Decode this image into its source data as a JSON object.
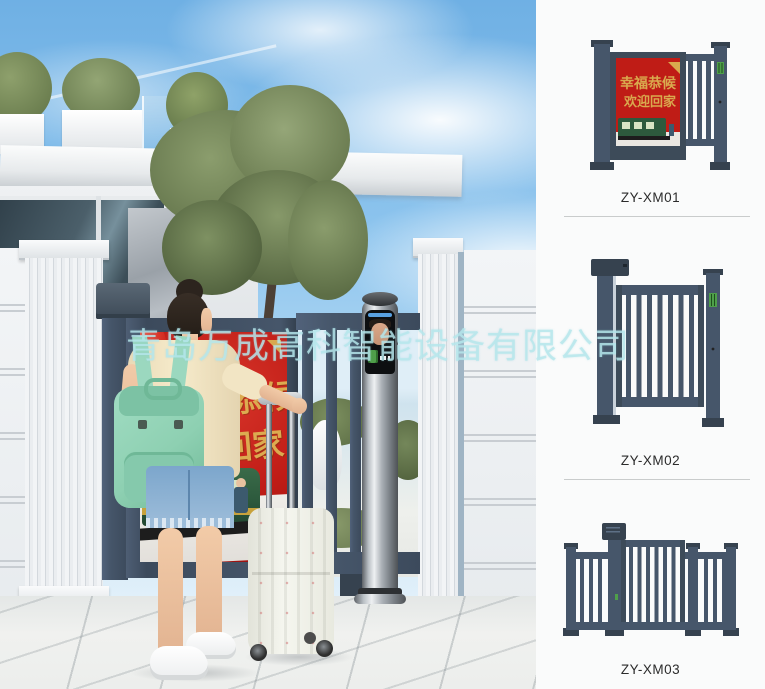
{
  "watermark": {
    "text": "青岛万成高科智能设备有限公司"
  },
  "poster": {
    "line1": "幸福恭候",
    "line2": "欢迎回家"
  },
  "products": [
    {
      "label": "ZY-XM01"
    },
    {
      "label": "ZY-XM02"
    },
    {
      "label": "ZY-XM03"
    }
  ],
  "colors": {
    "gate_slate": "#46566a",
    "poster_red": "#bf1c16",
    "poster_gold": "#d9a94e",
    "train_green": "#2d5a3d",
    "backpack_mint": "#8ed0b2",
    "watermark_cyan": "#b6e7ec",
    "pedestal_steel": "#b9bfc4",
    "catalog_bg": "#fafbfb"
  }
}
